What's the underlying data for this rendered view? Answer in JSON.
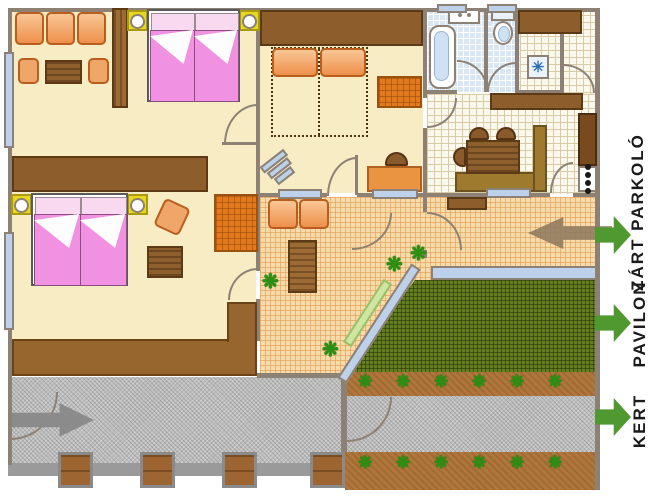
{
  "labels": {
    "closed_parking": "ZÁRT PARKOLÓ",
    "pavilion": "PAVILON",
    "garden": "KERT"
  },
  "palette": {
    "wall": "#8c8174",
    "room_floor": "#f7ecc4",
    "terrace_tile": "#f6dcab",
    "bath_tile": "#d9e7f5",
    "kitchen_tile": "#fbf8ee",
    "lawn_green": "#647f1e",
    "soil_brown": "#b0773c",
    "gravel_gray": "#bcbcbc",
    "furniture_wood": "#8d5d2b",
    "sofa_orange": "#ee8f4b",
    "bed_pink": "#f191e2",
    "lamp_yellow": "#e9d71f",
    "window_blue": "#bdd2ea",
    "plant_green": "#2c8e12",
    "label_arrow_green": "#4f9930",
    "entry_arrow_gray": "#8b8b8b",
    "parking_arrow_brown": "#8f7a5e"
  },
  "icons": {
    "plant_glyph": "❋",
    "appliance_asterisk_glyph": "✳"
  },
  "garden": {
    "terrace_plants": [
      {
        "x": 262,
        "y": 272
      },
      {
        "x": 322,
        "y": 340
      },
      {
        "x": 386,
        "y": 255
      },
      {
        "x": 410,
        "y": 244
      }
    ],
    "flower_bed_top": {
      "plant_y": 373,
      "plants_x": [
        358,
        396,
        434,
        472,
        510,
        548
      ]
    },
    "flower_bed_bottom": {
      "plant_y": 454,
      "plants_x": [
        358,
        396,
        434,
        472,
        510,
        548
      ]
    }
  },
  "pillars": {
    "y": 452,
    "width": 35,
    "height": 36,
    "x_positions": [
      58,
      140,
      222,
      310
    ]
  }
}
